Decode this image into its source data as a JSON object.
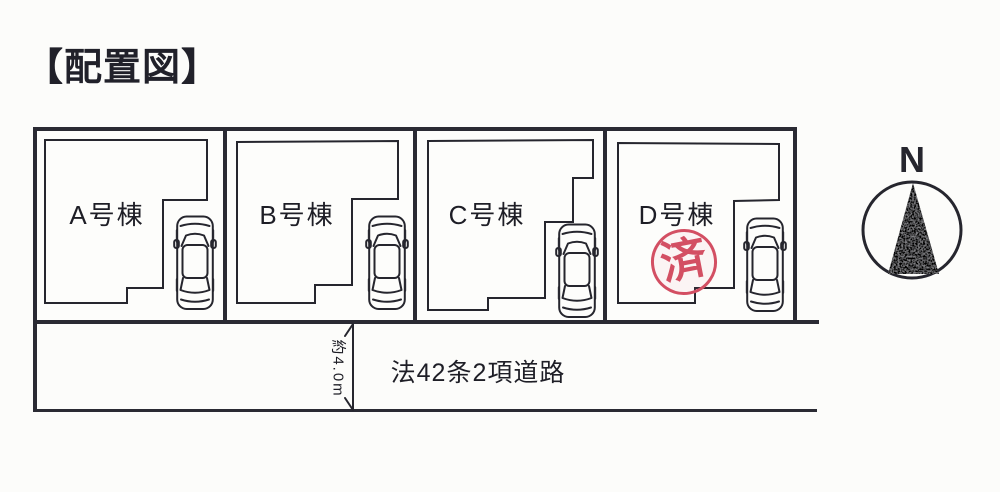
{
  "title": "【配置図】",
  "lots": [
    {
      "id": "A",
      "label": "A号棟"
    },
    {
      "id": "B",
      "label": "B号棟"
    },
    {
      "id": "C",
      "label": "C号棟"
    },
    {
      "id": "D",
      "label": "D号棟",
      "stamp": "済"
    }
  ],
  "road": {
    "label": "法42条2項道路",
    "width_label": "約4.0m"
  },
  "compass": {
    "north_label": "N"
  },
  "icons": {
    "car": "car-top-view-icon",
    "north_needle": "north-arrow-icon",
    "stamp": "sold-stamp"
  },
  "colors": {
    "ink": "#2a2a33",
    "stamp_red": "#d34f63",
    "paper": "#fcfcfa"
  }
}
